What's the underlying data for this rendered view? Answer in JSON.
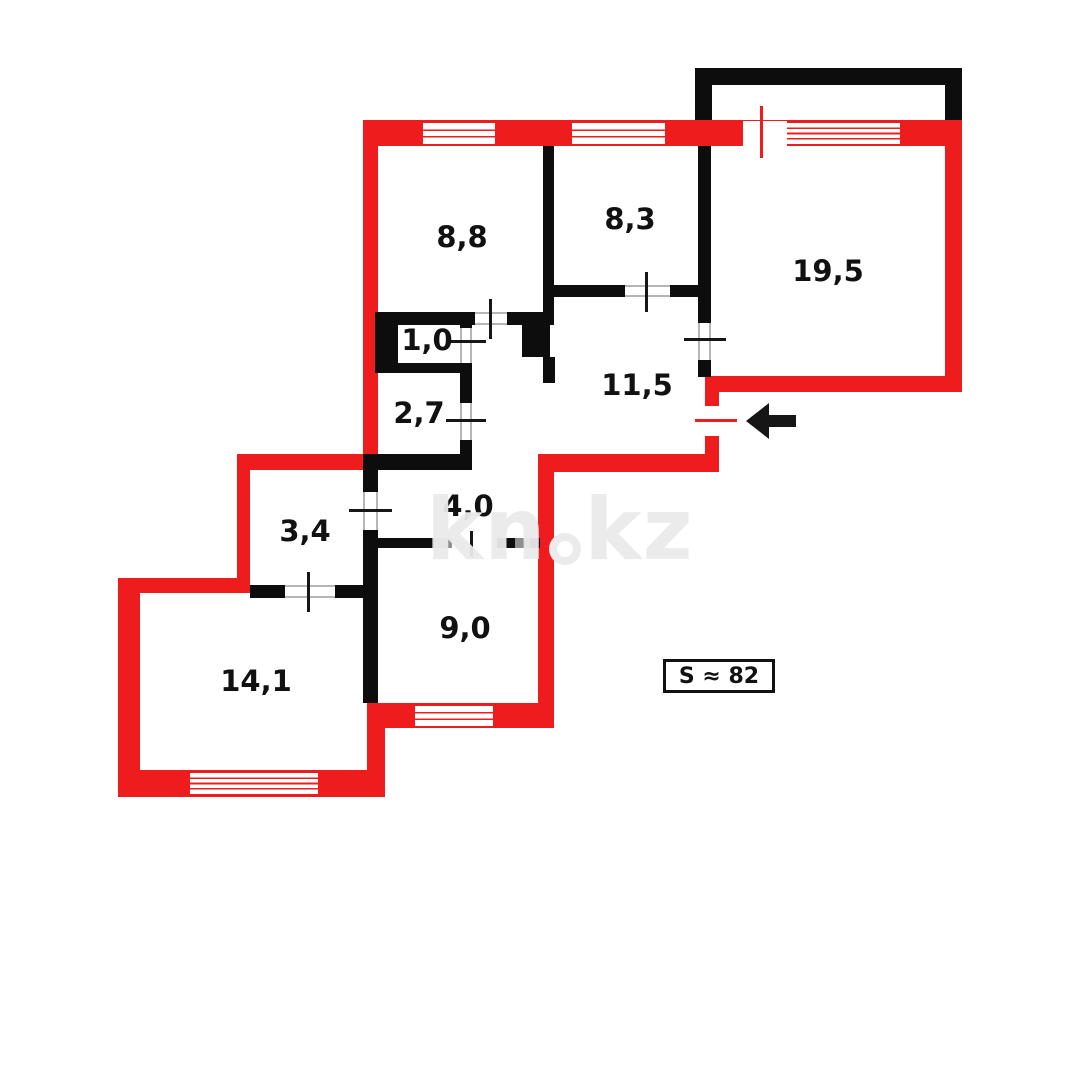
{
  "plan": {
    "type": "apartment-floor-plan",
    "total_area": {
      "label": "S ≈ 82"
    },
    "entrance": {
      "arrow_direction": "left"
    },
    "watermark": {
      "left": "kn",
      "right": "kz"
    },
    "rooms": [
      {
        "area": "8,8"
      },
      {
        "area": "8,3"
      },
      {
        "area": "19,5"
      },
      {
        "area": "1,0"
      },
      {
        "area": "2,7"
      },
      {
        "area": "11,5"
      },
      {
        "area": "3,4"
      },
      {
        "area": "4,0"
      },
      {
        "area": "9,0"
      },
      {
        "area": "14,1"
      }
    ],
    "colors": {
      "wall_exterior": "#ee1c1c",
      "wall_interior": "#0d0d0d",
      "door_frame_gray": "#8e8e8e",
      "watermark_gray": "#eaeaea",
      "background": "#ffffff",
      "text": "#111111"
    }
  }
}
